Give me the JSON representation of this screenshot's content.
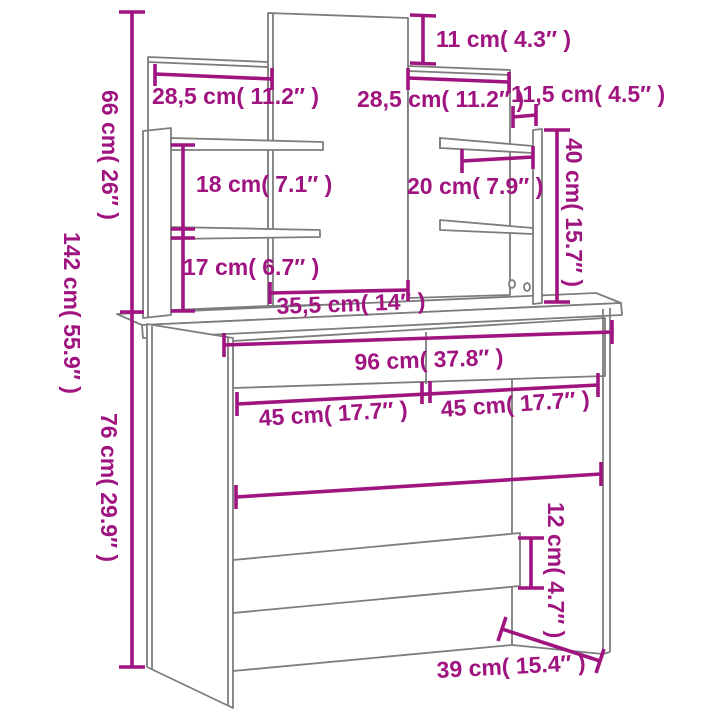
{
  "colors": {
    "dimension": "#A01480",
    "outline": "#7D7D7D",
    "background": "#FFFFFF"
  },
  "labels": {
    "total_height": "142 cm( 55.9″ )",
    "upper_section_height": "66 cm( 26″ )",
    "table_height": "76 cm( 29.9″ )",
    "left_shelf_width": "28,5 cm( 11.2″ )",
    "right_shelf_width": "28,5 cm( 11.2″ )",
    "mirror_top_offset": "11 cm( 4.3″ )",
    "right_gap_width": "11,5 cm( 4.5″ )",
    "left_shelf_spacing": "18 cm( 7.1″ )",
    "right_shelf_depth": "20 cm( 7.9″ )",
    "right_support_height": "40 cm( 15.7″ )",
    "lower_shelf_height": "17 cm( 6.7″ )",
    "mirror_width": "35,5 cm( 14″ )",
    "table_width": "96 cm( 37.8″ )",
    "drawer_left_width": "45 cm( 17.7″ )",
    "drawer_right_width": "45 cm( 17.7″ )",
    "stretcher_height": "12 cm( 4.7″ )",
    "table_depth": "39 cm( 15.4″ )"
  }
}
